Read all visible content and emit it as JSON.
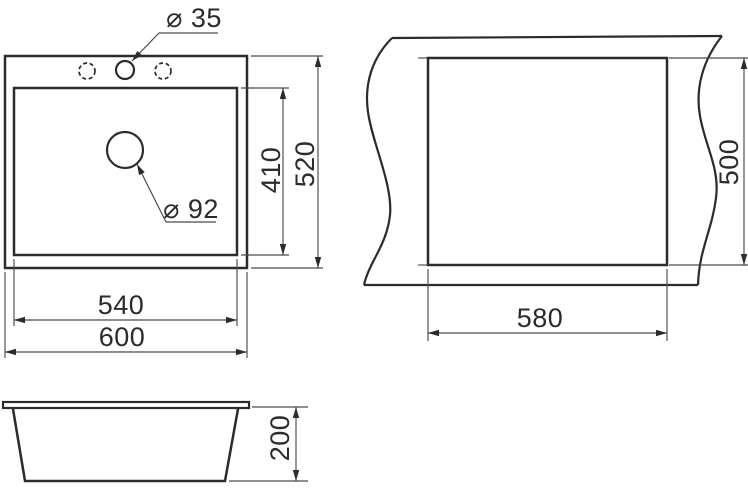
{
  "colors": {
    "line": "#2b2b2b",
    "thin_line": "#4a4a4a",
    "text": "#2b2b2b",
    "background": "#ffffff"
  },
  "top_view": {
    "faucet_hole_diameter": "⌀ 35",
    "drain_diameter": "⌀ 92",
    "bowl_width": "540",
    "overall_width": "600",
    "bowl_depth": "410",
    "overall_depth": "520"
  },
  "cutout_view": {
    "cutout_width": "580",
    "cutout_depth": "500"
  },
  "side_view": {
    "overall_height": "200"
  }
}
